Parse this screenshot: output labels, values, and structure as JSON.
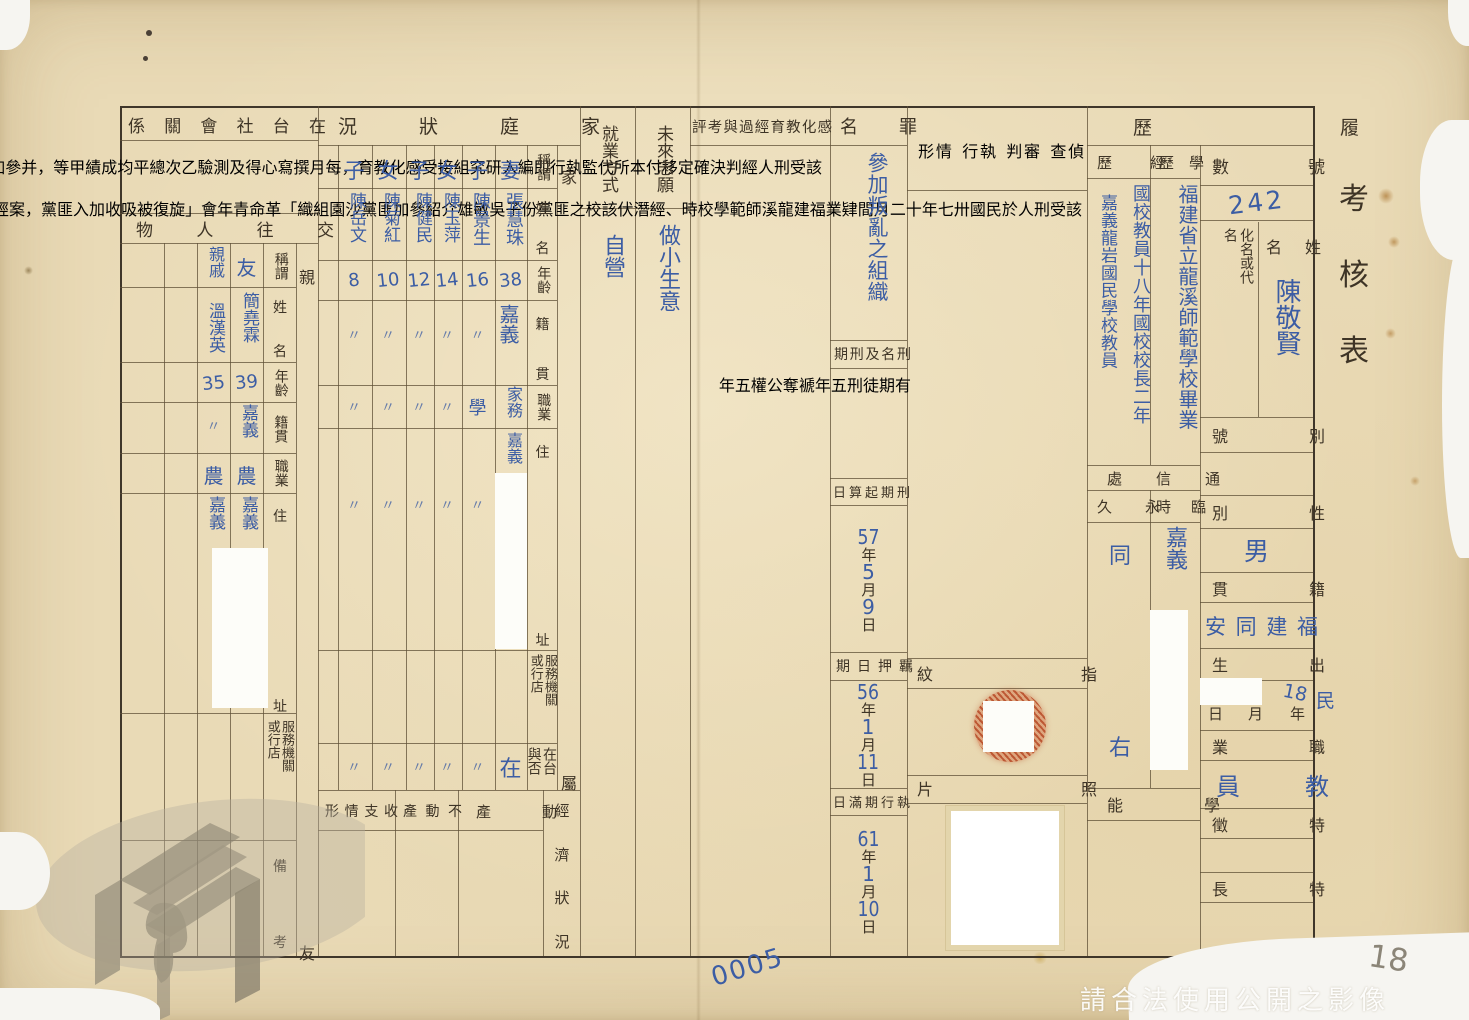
{
  "title": "考核表",
  "footer": {
    "watermark": "請合法使用公開之影像",
    "page_number": "0005",
    "pencil_note": "18"
  },
  "colors": {
    "paper": "#e9dab6",
    "print_ink": "#3e3426",
    "hand_ink": "#3c5da4",
    "line": "#5f5037",
    "fingerprint_red": "#b84a26"
  },
  "resume": {
    "section_label": "履歷",
    "number_label": "號數",
    "number_value": "242",
    "name_label": "姓名",
    "name_value": "陳敬賢",
    "alias_label": "化名或代名",
    "alias_value": "",
    "byname_label": "別號",
    "byname_value": "",
    "sex_label": "性別",
    "sex_value": "男",
    "origin_label": "籍貫",
    "origin_value": "福建同安",
    "birth_label": "出生",
    "birth_era": "民",
    "birth_year": "18",
    "unit_year": "年",
    "unit_month": "月",
    "unit_day": "日",
    "occupation_label": "職業",
    "occupation_value": "教員",
    "feature_label": "特徵",
    "feature_value": "",
    "specialty_label": "特長",
    "specialty_value": "",
    "education_label": "學歷",
    "education_value": "福建省立龍溪師範學校畢業",
    "experience_label": "經歷",
    "experience_value_1": "國校教員十八年國校校長二年",
    "experience_value_2": "嘉義龍岩國民學校教員",
    "contact_label": "通信處",
    "permanent_label": "永久",
    "permanent_value": "同右",
    "temporary_label": "臨時",
    "temporary_value": "嘉義",
    "ability_label": "學能",
    "ability_value": ""
  },
  "investigation": {
    "header_labels": [
      "偵查",
      "審判",
      "執行",
      "情形"
    ],
    "text_columns": [
      "該受刑人於民國卅七年十二月間肄業福建龍溪師範學校",
      "時、經潛伏該校之匪黨份子吳敏雄介紹參加匪黨沙園組織",
      "「革命青年會」旋復被吸收加入匪黨，案經調查局查覺",
      "扣解本部軍事檢察官偵查起訴並經審明判處",
      "有期徒刑五年褫奪公權五年現仍在本部軍法處",
      "看守所代監執行中。"
    ],
    "fingerprint_label": "指紋",
    "photo_label": "照片"
  },
  "crime": {
    "label": "罪名",
    "value": "參加叛亂之組織",
    "sentence_label": "刑名及刑期",
    "sentence1_pre": "有期徒刑",
    "sentence1_num": "五",
    "sentence1_unit": "年",
    "sentence2_pre": "褫奪公權",
    "sentence2_num": "五",
    "sentence2_unit": "年",
    "start_label": "刑期起算日",
    "start": {
      "y": "57",
      "m": "5",
      "d": "9"
    },
    "detention_label": "羈押日期",
    "detention": {
      "y": "56",
      "m": "1",
      "d": "11"
    },
    "completion_label": "執行期滿日",
    "completion": {
      "y": "61",
      "m": "1",
      "d": "10"
    },
    "unit_year": "年",
    "unit_month": "月",
    "unit_day": "日"
  },
  "reform": {
    "header": "感化教育經過與考評",
    "text_columns": [
      "該受刑人經判決確定移付本所代監執行即編入研究組接受感化教育，每月撰寫",
      "心得及測驗乙次總平均成績甲等，并參加洗衣作業，平日沉默寡言，工作認真，",
      "力求上進，肯學習，生活簡樸。"
    ]
  },
  "future": {
    "aspiration_label": "未來志願",
    "aspiration_value": "做小生意",
    "employment_label": "就業方式",
    "employment_value": "自營"
  },
  "family": {
    "header": "家庭狀況",
    "group_label": "家屬",
    "row_labels": {
      "relation": "稱謂",
      "name": "姓名",
      "age": "年齡",
      "origin": "籍貫",
      "occupation": "職業",
      "address": "住址",
      "workplace": "服務機關或行店",
      "in_taiwan": "在台與否"
    },
    "members": [
      {
        "relation": "妻",
        "name": "張慧珠",
        "age": "38",
        "origin": "嘉義",
        "occupation": "家務",
        "address": "嘉義",
        "in_taiwan": "在"
      },
      {
        "relation": "子",
        "name": "陳景生",
        "age": "16",
        "origin": "〃",
        "occupation": "學",
        "address": "〃",
        "in_taiwan": "〃"
      },
      {
        "relation": "女",
        "name": "陳玉萍",
        "age": "14",
        "origin": "〃",
        "occupation": "〃",
        "address": "〃",
        "in_taiwan": "〃"
      },
      {
        "relation": "子",
        "name": "陳健民",
        "age": "12",
        "origin": "〃",
        "occupation": "〃",
        "address": "〃",
        "in_taiwan": "〃"
      },
      {
        "relation": "女",
        "name": "陳菊紅",
        "age": "10",
        "origin": "〃",
        "occupation": "〃",
        "address": "〃",
        "in_taiwan": "〃"
      },
      {
        "relation": "子",
        "name": "陳岳文",
        "age": "8",
        "origin": "〃",
        "occupation": "〃",
        "address": "〃",
        "in_taiwan": "〃"
      }
    ],
    "economy_label": "經濟狀況",
    "economy_columns": [
      "動產",
      "不動產",
      "收支情形"
    ]
  },
  "social": {
    "header": "在台社會關係",
    "sub_header": "交往人物",
    "group_label": "親友",
    "row_labels": {
      "relation": "稱謂",
      "name": "姓名",
      "age": "年齡",
      "origin": "籍貫",
      "occupation": "職業",
      "address": "住址",
      "workplace": "服務機關或行店",
      "remarks": "備考"
    },
    "contacts": [
      {
        "relation": "友",
        "name": "簡堯霖",
        "age": "39",
        "origin": "嘉義",
        "occupation": "農",
        "address": "嘉義"
      },
      {
        "relation": "親戚",
        "name": "溫漢英",
        "age": "35",
        "origin": "〃",
        "occupation": "農",
        "address": "嘉義"
      }
    ]
  }
}
